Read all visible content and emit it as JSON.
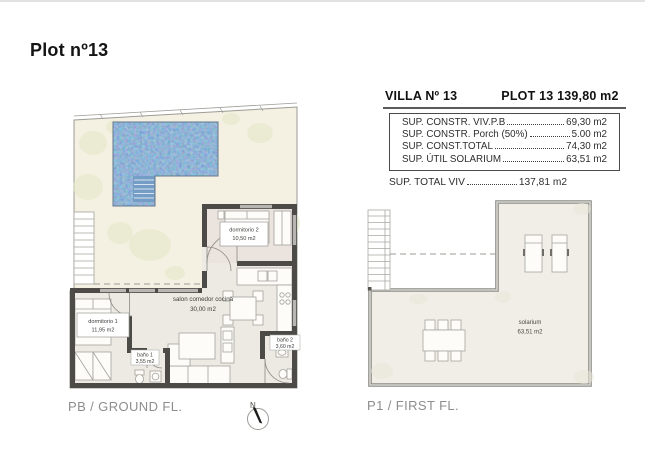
{
  "window": {
    "title": "Plot nº13"
  },
  "info_panel": {
    "villa": "VILLA Nº 13",
    "plot": "PLOT 13 139,80 m2",
    "rows": [
      {
        "label": "SUP. CONSTR. VIV.P.B",
        "value": "69,30 m2"
      },
      {
        "label": "SUP. CONSTR. Porch (50%)",
        "value": "5.00 m2"
      },
      {
        "label": "SUP. CONST.TOTAL",
        "value": "74,30 m2"
      },
      {
        "label": "SUP. ÚTIL SOLARIUM",
        "value": "63,51 m2"
      }
    ],
    "total_row": {
      "label": "SUP. TOTAL VIV",
      "value": "137,81 m2"
    }
  },
  "ground_floor": {
    "caption": "PB / GROUND FL.",
    "rooms": [
      {
        "name": "dormitorio 1",
        "area": "11,95 m2"
      },
      {
        "name": "dormitorio 2",
        "area": "10,50 m2"
      },
      {
        "name": "salon comedor cocina",
        "area": "30,00 m2"
      },
      {
        "name": "baño 1",
        "area": "3,55 m2"
      },
      {
        "name": "baño 2",
        "area": "3,60 m2"
      }
    ]
  },
  "first_floor": {
    "caption": "P1 / FIRST FL.",
    "rooms": [
      {
        "name": "solarium",
        "area": "63,51 m2"
      }
    ]
  },
  "compass": {
    "north": "N"
  },
  "colors": {
    "terrace": "#f4f1e2",
    "pool": "#4a7cb0",
    "wall": "#4c4b48",
    "room_floor": "#eceae3",
    "solarium_floor": "#f0eee7"
  }
}
